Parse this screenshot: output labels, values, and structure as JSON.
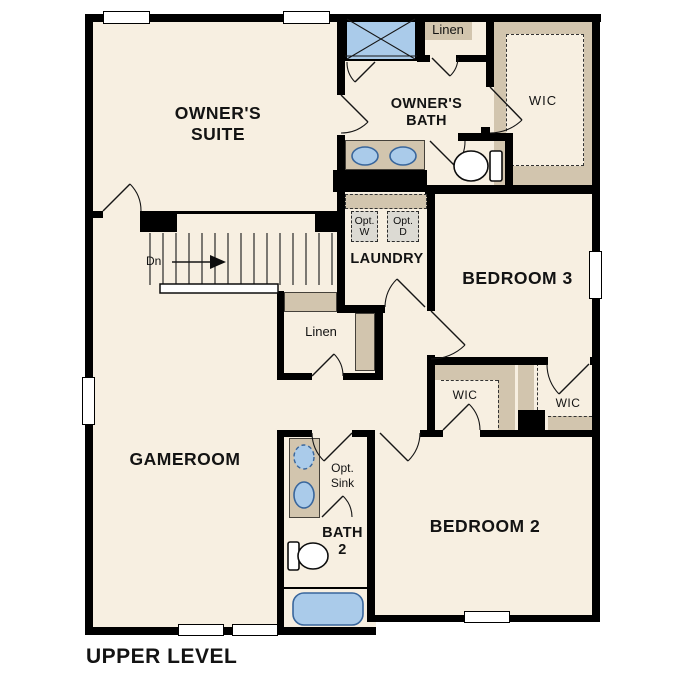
{
  "title": "UPPER LEVEL",
  "colors": {
    "wall": "#000000",
    "floor": "#f7efe1",
    "casework": "#d2c5ae",
    "fixture_blue": "#aacbea",
    "fixture_border": "#39669c",
    "optional_gray": "#dcdad3"
  },
  "labels": {
    "owners_suite_1": "OWNER'S",
    "owners_suite_2": "SUITE",
    "owners_bath_1": "OWNER'S",
    "owners_bath_2": "BATH",
    "linen_top": "Linen",
    "wic_top": "WIC",
    "opt_w_1": "Opt.",
    "opt_w_2": "W",
    "opt_d_1": "Opt.",
    "opt_d_2": "D",
    "laundry": "LAUNDRY",
    "bedroom3": "BEDROOM 3",
    "linen_mid": "Linen",
    "stairs_dn": "Dn",
    "gameroom": "GAMEROOM",
    "wic_left": "WIC",
    "wic_right": "WIC",
    "opt_sink_1": "Opt.",
    "opt_sink_2": "Sink",
    "bath2_1": "BATH",
    "bath2_2": "2",
    "bedroom2": "BEDROOM 2"
  }
}
